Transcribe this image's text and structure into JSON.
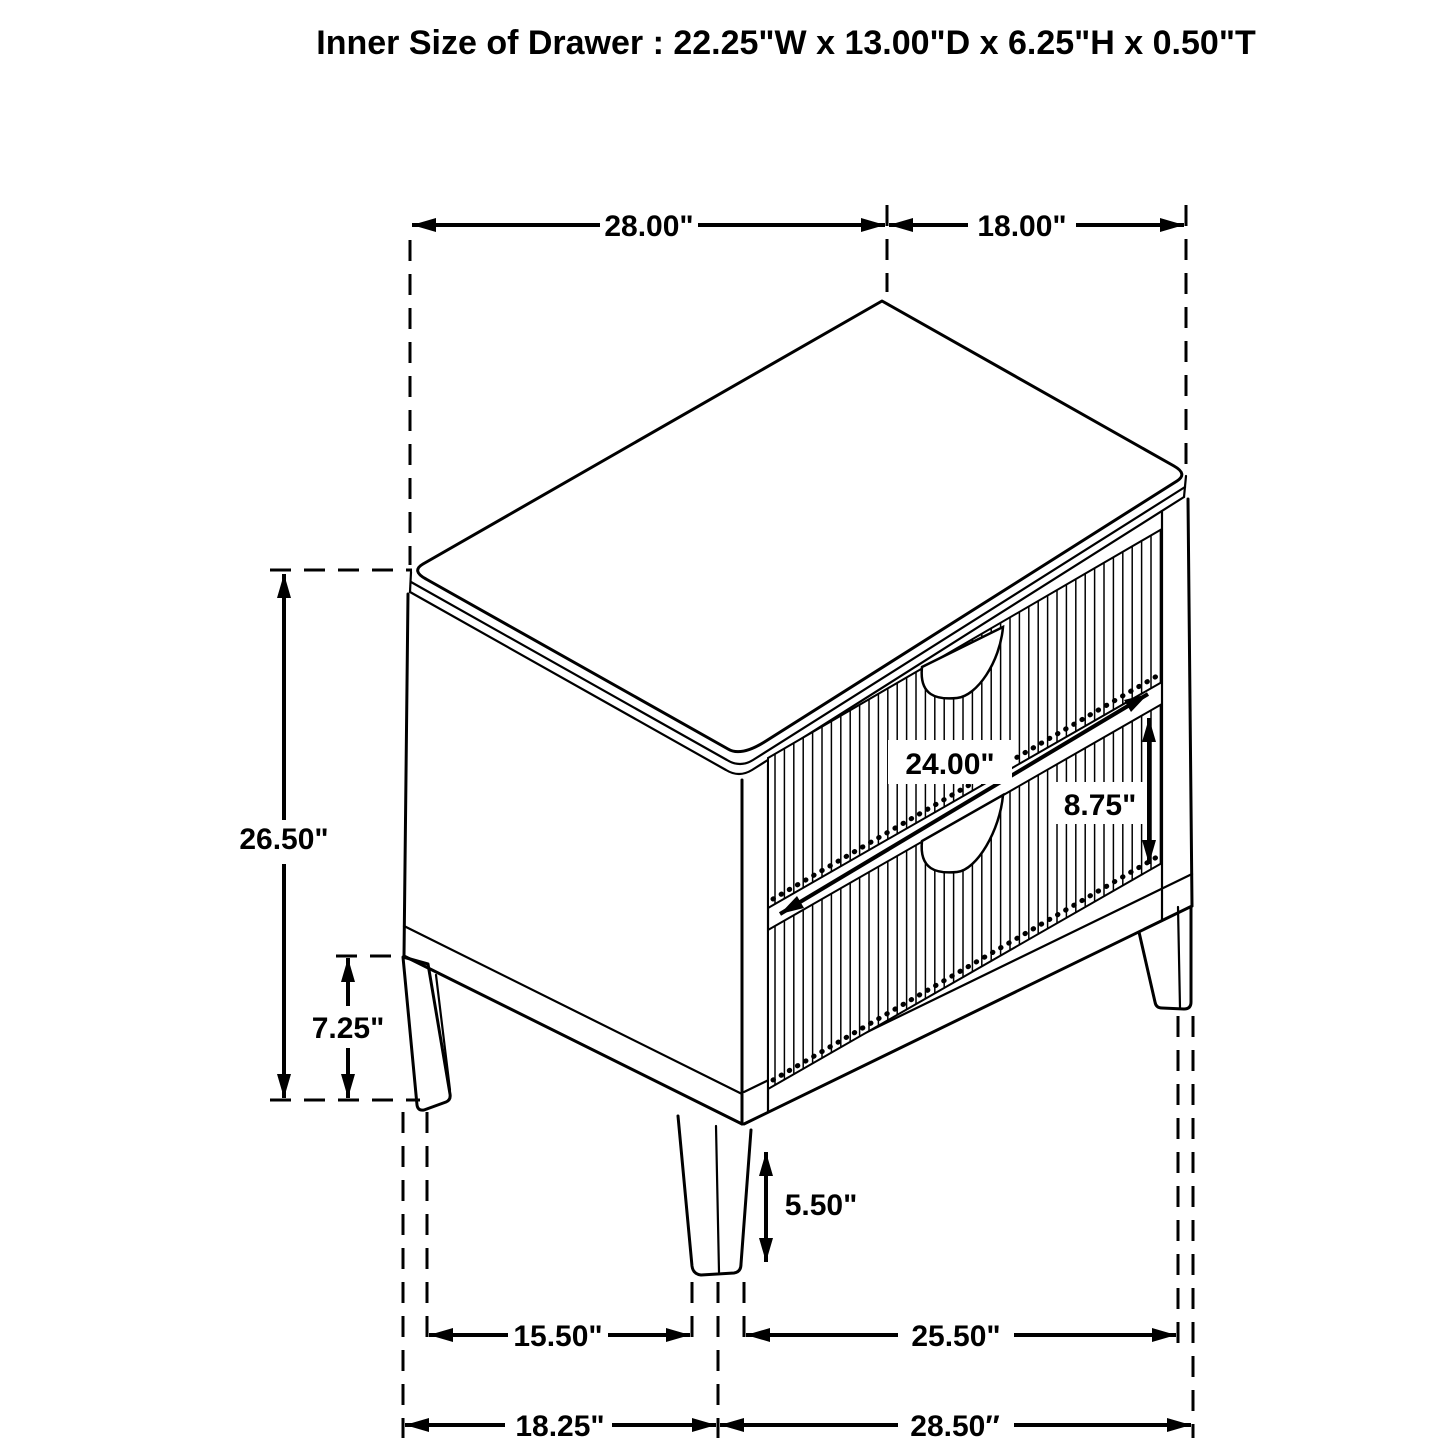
{
  "title": "Inner Size of Drawer : 22.25\"W x 13.00\"D x 6.25\"H x 0.50\"T",
  "dimensions": {
    "top_width": "28.00\"",
    "top_depth": "18.00\"",
    "overall_height": "26.50\"",
    "base_height": "7.25\"",
    "drawer_width": "24.00\"",
    "drawer_front_height": "8.75\"",
    "leg_height": "5.50\"",
    "floor_span_left": "15.50\"",
    "floor_span_right": "25.50\"",
    "base_width": "18.25\"",
    "base_depth": "28.50″"
  },
  "colors": {
    "line": "#000000",
    "background": "#ffffff"
  }
}
